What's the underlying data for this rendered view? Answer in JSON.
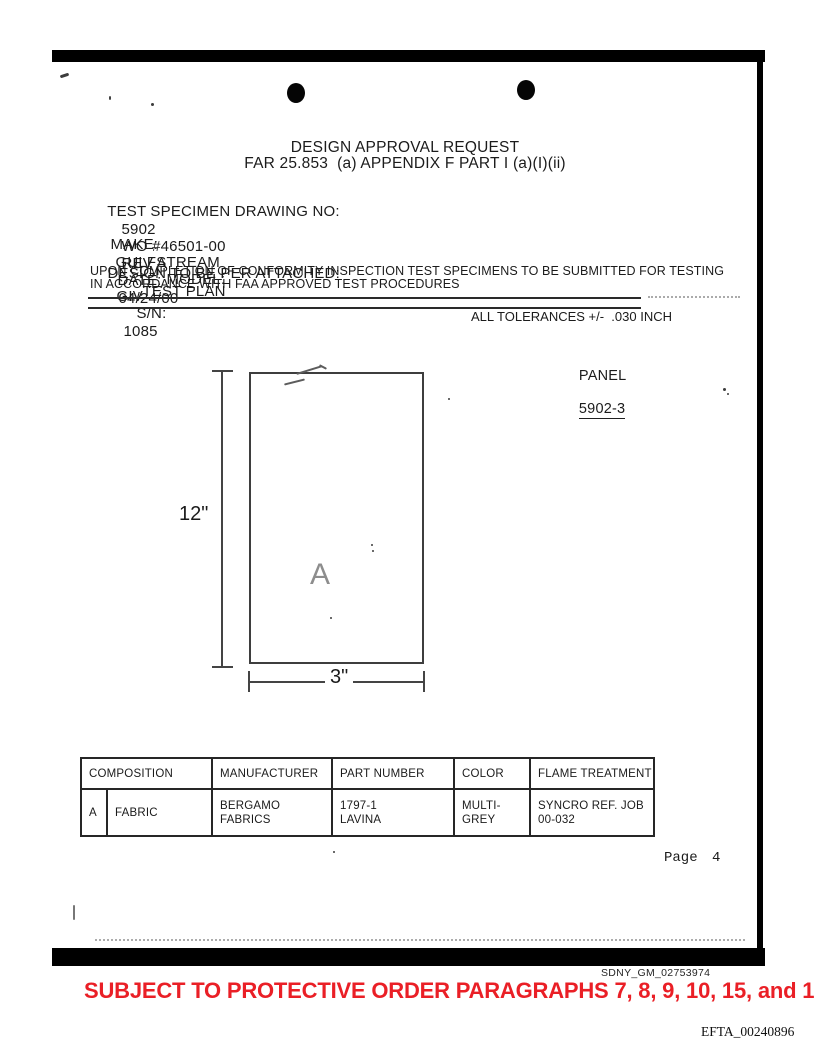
{
  "header": {
    "title": "DESIGN APPROVAL REQUEST",
    "subtitle": "FAR 25.853  (a) APPENDIX F PART I (a)(I)(ii)"
  },
  "fields": {
    "test_specimen": {
      "label": "TEST SPECIMEN DRAWING NO:",
      "drawing_no": "5902",
      "work_order": "WO #46501-00",
      "rev": "REV A",
      "date_label": "DATE:",
      "date": "04/24/00"
    },
    "make": {
      "label": "MAKE:",
      "value": "GULFSTREAM",
      "model_label": "MODEL:",
      "model": "GIV",
      "sn_label": "S/N:",
      "sn": "1085"
    },
    "design": {
      "label": "DESIGN TO BE PER ATTACHED:",
      "value": "TEST PLAN"
    },
    "note_line1": "UPON COMPLETION OF CONFORMITY INSPECTION TEST SPECIMENS TO BE SUBMITTED FOR TESTING",
    "note_line2": "IN ACCORDANCE WITH FAA APPROVED TEST PROCEDURES",
    "tolerances": "ALL TOLERANCES +/-  .030 INCH",
    "panel_label": "PANEL",
    "panel_no": "5902-3"
  },
  "drawing": {
    "height_dim": "12\"",
    "width_dim": "3\"",
    "material_key": "A"
  },
  "table": {
    "headers": [
      "COMPOSITION",
      "MANUFACTURER",
      "PART NUMBER",
      "COLOR",
      "FLAME TREATMENT"
    ],
    "row": {
      "key": "A",
      "composition": "FABRIC",
      "manufacturer": "BERGAMO FABRICS",
      "part_number": [
        "1797-1",
        "LAVINA"
      ],
      "color": [
        "MULTI-",
        "GREY"
      ],
      "flame_treatment": [
        "SYNCRO REF. JOB",
        "00-032"
      ]
    }
  },
  "footer": {
    "page_number": "Page 4",
    "bates_sdny": "SDNY_GM_02753974",
    "stamp": "SUBJECT TO PROTECTIVE ORDER PARAGRAPHS 7, 8, 9, 10, 15, and 17",
    "bates_efta": "EFTA_00240896"
  },
  "colors": {
    "stamp_red": "#ea1f26",
    "ink": "#1b1b1b",
    "line": "#1f1f1f"
  }
}
